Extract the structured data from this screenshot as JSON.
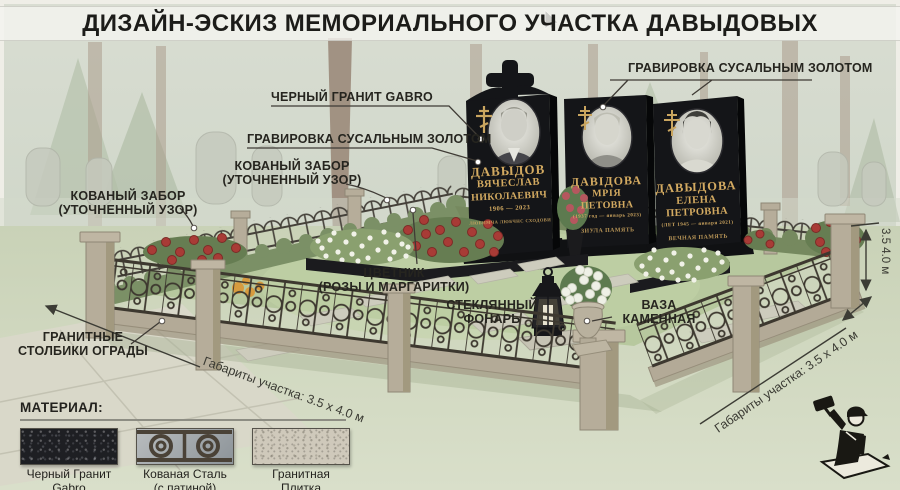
{
  "title": "ДИЗАЙН-ЭСКИЗ МЕМОРИАЛЬНОГО УЧАСТКА ДАВЫДОВЫХ",
  "callouts": {
    "black_granite": "ЧЕРНЫЙ ГРАНИТ GABRO",
    "engraving_left": "ГРАВИРОВКА СУСАЛЬНЫМ ЗОЛОТОМ",
    "engraving_right": "ГРАВИРОВКА СУСАЛЬНЫМ ЗОЛОТОМ",
    "fence_center": {
      "line1": "КОВАНЫЙ ЗАБОР",
      "line2": "(УТОЧНЕННЫЙ УЗОР)"
    },
    "fence_left": {
      "line1": "КОВАНЫЙ ЗАБОР",
      "line2": "(УТОЧНЕННЫЙ УЗОР)"
    },
    "granite_posts": {
      "line1": "ГРАНИТНЫЕ",
      "line2": "СТОЛБИКИ ОГРАДЫ"
    },
    "flowerbed": {
      "line1": "ЦВЕТНИК",
      "line2": "(РОЗЫ И МАРГАРИТКИ)"
    },
    "lantern": {
      "line1": "СТЕКЛЯННЫЙ",
      "line2": "ФОНАРЬ"
    },
    "vase": {
      "line1": "ВАЗА",
      "line2": "КАМЕННАЯ"
    }
  },
  "dimensions": {
    "bottom_left": "Габариты участка: 3.5 х 4.0 м",
    "right_rotated": "Габариты участка: 3.5 х 4.0 м",
    "right_vertical": "3.5 4.0 м"
  },
  "monuments": [
    {
      "surname": "ДАВЫДОВ",
      "name": "ВЯЧЕСЛАВ",
      "patronymic": "НИКОЛАЕВИЧ",
      "years": "1906 — 2023",
      "epitaph": "ЛЮБИМЧА ЛЮБЧНС СХОДОВИ"
    },
    {
      "surname": "ДАВІДОВА",
      "name": "МРІЯ",
      "patronymic": "ПЕТОВНА",
      "years": "(1937 год — январь 2023)",
      "epitaph": "ЗИУЛА ПАМЯТЬ"
    },
    {
      "surname": "ДАВЫДОВА",
      "name": "ЕЛЕНА",
      "patronymic": "ПЕТРОВНА",
      "years": "(ЛЕТ 1945 — января 2021)",
      "epitaph": "ВЕЧНАЯ ПАМЯТЬ"
    }
  ],
  "materials": {
    "heading": "МАТЕРИАЛ:",
    "items": [
      {
        "line1": "Черный Гранит",
        "line2": "Gabro"
      },
      {
        "line1": "Кованая Сталь",
        "line2": "(с патиной)"
      },
      {
        "line1": "Гранитная",
        "line2": "Плитка"
      }
    ]
  },
  "colors": {
    "background": "#ced5c8",
    "grass": "#b7c89e",
    "hedge": "#7b9066",
    "granite_black": "#141518",
    "gold_engraving": "#d3aa61",
    "iron": "#3d382f",
    "granite_post": "#b6ad9a",
    "rose_red": "#a83b36",
    "daisy_white": "#f1f2e8",
    "label_ink": "#26251f"
  },
  "icons": {
    "logo": "stonemason-logo",
    "cursor": "cursor-icon"
  }
}
